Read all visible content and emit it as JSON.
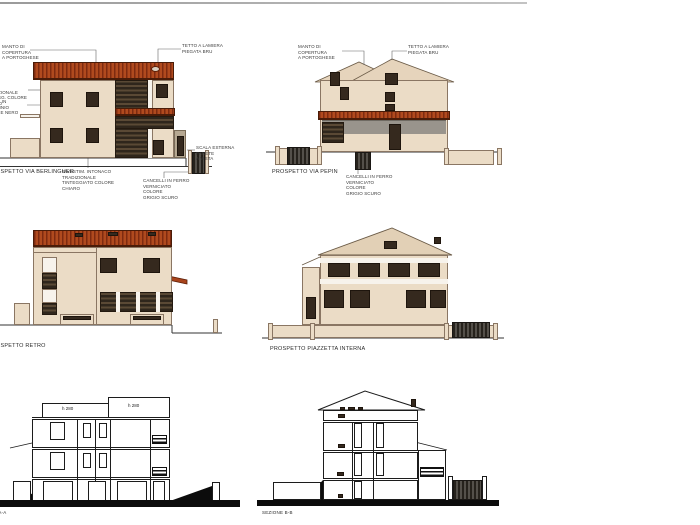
{
  "sheet": {
    "background": "#FFFFFF",
    "top_border_color": "#A8A8A8"
  },
  "palette": {
    "roof_red": "#B04A1E",
    "roof_red_dark": "#7E2B10",
    "roof_tan": "#E6D4BC",
    "wall_cream": "#EBDCC6",
    "window_dark": "#35291E",
    "gray_band": "#99948C",
    "section_line": "#1C1C1C",
    "ground_black": "#0C0C0C"
  },
  "p1": {
    "title": "PROSPETTO VIA BERLINGUER",
    "ann_manto": "MANTO DI COPERTURA\nA PORTOGHESE",
    "ann_tetto": "TETTO A LAMIERA\nPIEGATA BRU",
    "ann_intonaco": "INTON. TRADIZIONALE\nTINTEGG. COLORE CHIARO",
    "ann_infissi": "INFISSI IN ALLUMINIO\nCOLORE NERO",
    "ann_scala": "SCALA ESTERNA PARETE\nA VISTA",
    "ann_rivest": "RIVESTIM. INTONACO TRADIZIONALE\nTINTEGGIATO COLORE CHIARO",
    "ann_cancelli": "CANCELLI IN FERRO\nVERNICIATO COLORE\nGRIGIO SCURO"
  },
  "p2": {
    "title": "PROSPETTO VIA PEPIN",
    "ann_manto": "MANTO DI COPERTURA\nA PORTOGHESE",
    "ann_tetto": "TETTO A LAMIERA\nPIEGATA BRU",
    "ann_cancelli": "CANCELLI IN FERRO\nVERNICIATO COLORE\nGRIGIO SCURO"
  },
  "p3": {
    "title": "PROSPETTO RETRO"
  },
  "p4": {
    "title": "PROSPETTO PIAZZETTA INTERNA"
  },
  "p5": {
    "title": "SEZIONE A-A",
    "h_left": "h 280",
    "h_right": "h 280"
  },
  "p6": {
    "title": "SEZIONE B-B"
  }
}
